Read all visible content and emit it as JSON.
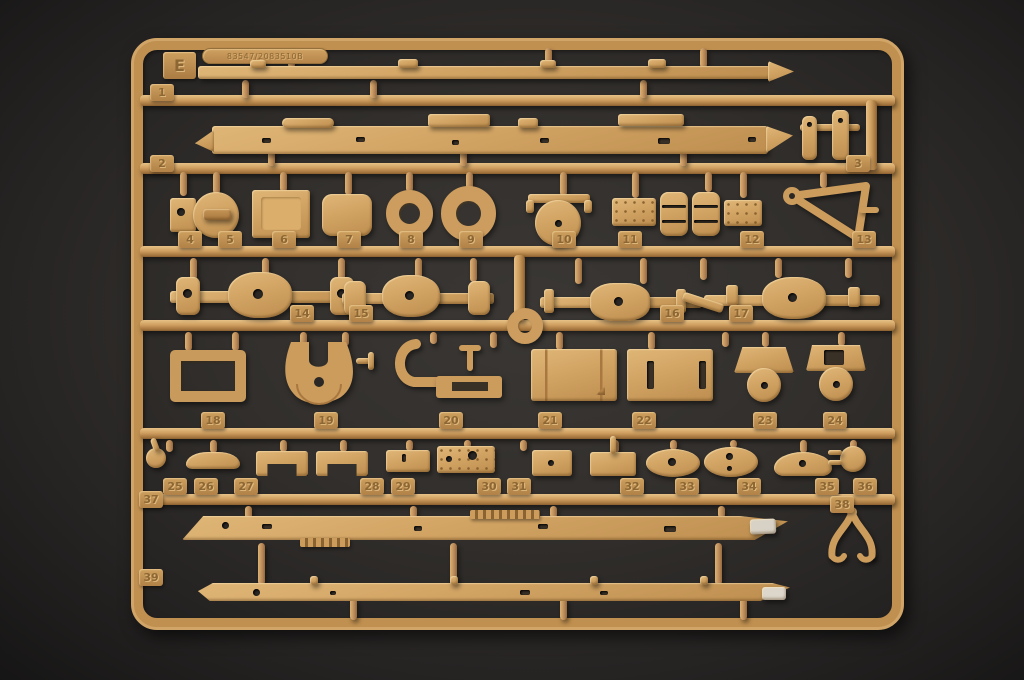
{
  "sprue": {
    "letter": "E",
    "mold_stamp": "83547/2083510B",
    "part_numbers": [
      "1",
      "2",
      "3",
      "4",
      "5",
      "6",
      "7",
      "8",
      "9",
      "10",
      "11",
      "12",
      "13",
      "14",
      "15",
      "16",
      "17",
      "18",
      "19",
      "20",
      "21",
      "22",
      "23",
      "24",
      "25",
      "26",
      "27",
      "28",
      "29",
      "30",
      "31",
      "32",
      "33",
      "34",
      "35",
      "36",
      "37",
      "38",
      "39"
    ],
    "plastic_color": "#cf9d5e",
    "background_color": "#2e2c29"
  }
}
